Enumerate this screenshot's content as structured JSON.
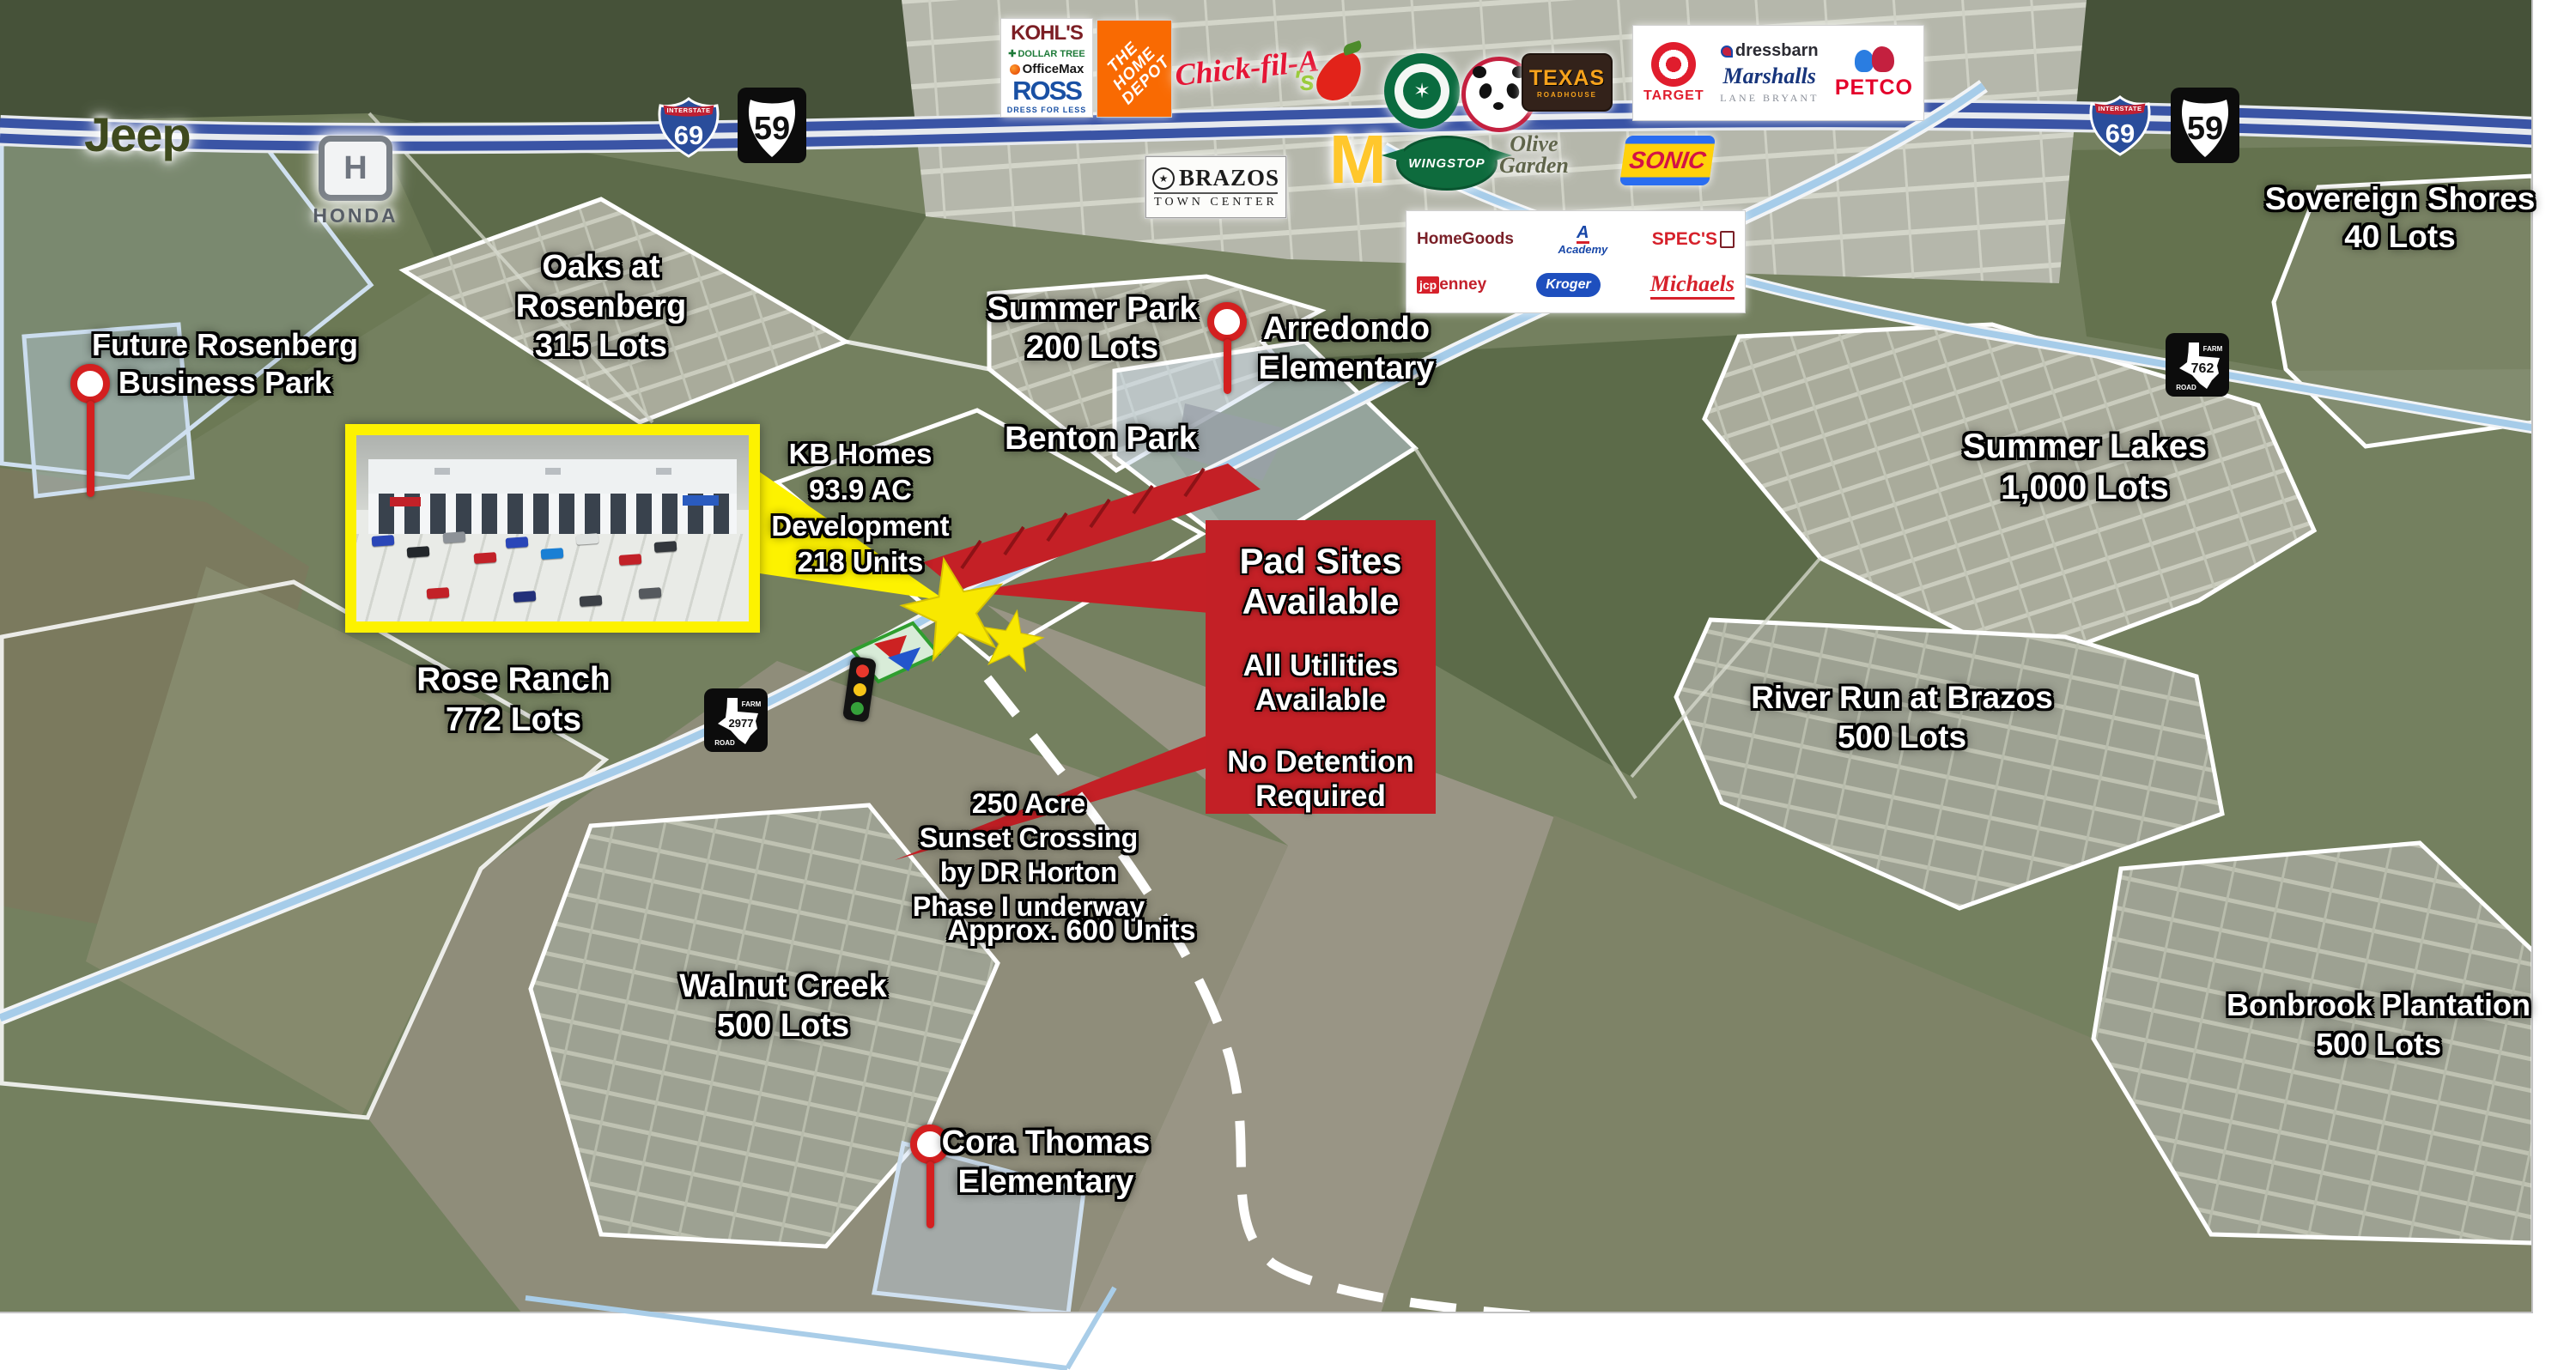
{
  "colors": {
    "callout_red": "#c32026",
    "site_yellow": "#fdf200",
    "freeway_blue": "#3a54a5",
    "road_blue": "#a6cce9",
    "pin_red": "#d42020"
  },
  "shields": {
    "interstate_label": "INTERSTATE",
    "i69": "69",
    "us59": "59",
    "farm": "FARM",
    "road": "ROAD",
    "fm762": "762",
    "fm2977": "2977"
  },
  "dealers": {
    "jeep": "Jeep",
    "honda_letter": "H",
    "honda": "HONDA"
  },
  "icons": {
    "dollar_tree_plus": "✚",
    "brazos_star": "★",
    "starbucks_siren": "✶",
    "mcdonalds_arches": "M"
  },
  "brands": {
    "kohls": "KOHL'S",
    "dollar_tree": "DOLLAR TREE",
    "officemax": "OfficeMax",
    "ross": "ROSS",
    "ross_tagline": "DRESS FOR LESS",
    "home_depot": [
      "THE",
      "HOME",
      "DEPOT"
    ],
    "chick_fil_a": "Chick-fil-A",
    "chilis_text": "'s",
    "texas_roadhouse": [
      "TEXAS",
      "ROADHOUSE"
    ],
    "target": "TARGET",
    "dressbarn": "dressbarn",
    "marshalls": "Marshalls",
    "lane_bryant": "LANE BRYANT",
    "petco": "PETCO",
    "wingstop": "WINGSTOP",
    "olive_garden": [
      "Olive",
      "Garden"
    ],
    "sonic": "SONIC",
    "homegoods": "HomeGoods",
    "academy_a": "A",
    "academy": "Academy",
    "specs": "SPEC'S",
    "jcpenney": [
      "jcp",
      "enney"
    ],
    "kroger": "Kroger",
    "michaels": "Michaels"
  },
  "town_center_sign": {
    "line1": "BRAZOS",
    "line2": "TOWN CENTER"
  },
  "callout": {
    "heading": [
      "Pad Sites",
      "Available"
    ],
    "utilities": [
      "All Utilities",
      "Available"
    ],
    "detention": [
      "No Detention",
      "Required"
    ]
  },
  "labels": [
    {
      "id": "future-rosenberg-business-park",
      "lines": [
        "Future Rosenberg",
        "Business Park"
      ]
    },
    {
      "id": "oaks-at-rosenberg",
      "lines": [
        "Oaks at",
        "Rosenberg",
        "315 Lots"
      ]
    },
    {
      "id": "summer-park",
      "lines": [
        "Summer Park",
        "200 Lots"
      ]
    },
    {
      "id": "arredondo-elementary",
      "lines": [
        "Arredondo",
        "Elementary"
      ]
    },
    {
      "id": "benton-park",
      "lines": [
        "Benton Park"
      ]
    },
    {
      "id": "sovereign-shores",
      "lines": [
        "Sovereign Shores",
        "40 Lots"
      ]
    },
    {
      "id": "summer-lakes",
      "lines": [
        "Summer Lakes",
        "1,000 Lots"
      ]
    },
    {
      "id": "kb-homes-development",
      "lines": [
        "KB Homes",
        "93.9 AC",
        "Development",
        "218 Units"
      ]
    },
    {
      "id": "rose-ranch",
      "lines": [
        "Rose Ranch",
        "772 Lots"
      ]
    },
    {
      "id": "river-run-at-brazos",
      "lines": [
        "River Run at Brazos",
        "500 Lots"
      ]
    },
    {
      "id": "sunset-crossing",
      "lines": [
        "250 Acre",
        "Sunset Crossing",
        "by DR Horton",
        "Phase I underway"
      ]
    },
    {
      "id": "sunset-crossing-units",
      "lines": [
        "Approx. 600 Units"
      ]
    },
    {
      "id": "walnut-creek",
      "lines": [
        "Walnut Creek",
        "500 Lots"
      ]
    },
    {
      "id": "cora-thomas-elementary",
      "lines": [
        "Cora Thomas",
        "Elementary"
      ]
    },
    {
      "id": "bonbrook-plantation",
      "lines": [
        "Bonbrook Plantation",
        "500 Lots"
      ]
    }
  ]
}
